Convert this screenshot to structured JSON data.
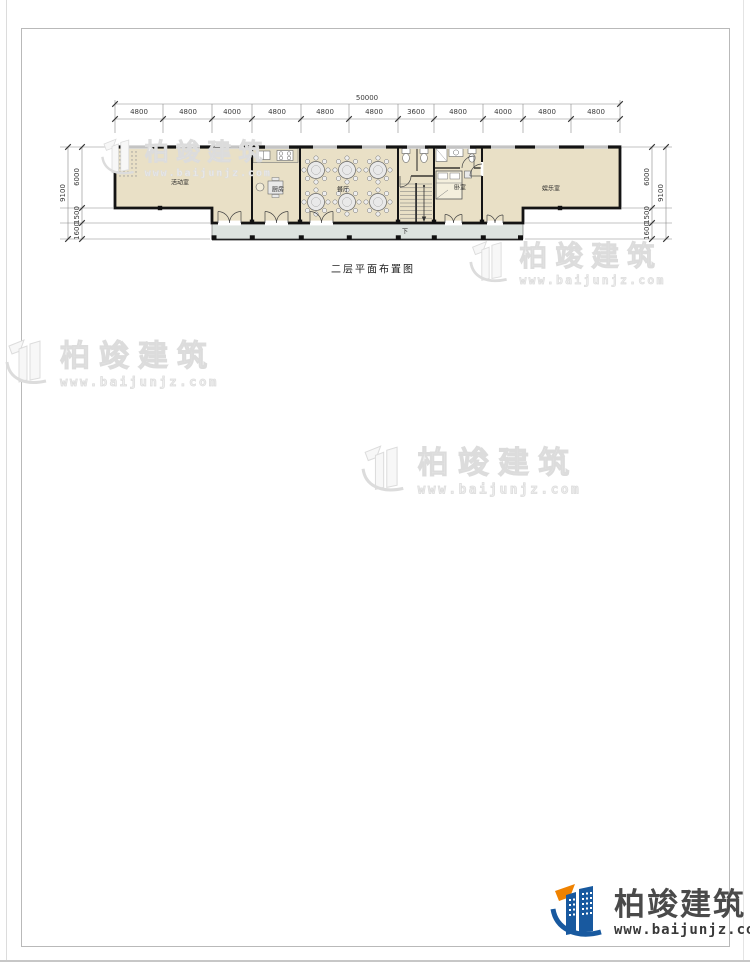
{
  "drawing_title": "二层平面布置图",
  "plan": {
    "room_labels": [
      "活动室",
      "厨房",
      "餐厅",
      "卧室",
      "娱乐室"
    ],
    "stair_down_label": "下"
  },
  "dimensions": {
    "top_total": "50000",
    "top_segments": [
      "4800",
      "4800",
      "4000",
      "4800",
      "4800",
      "4800",
      "3600",
      "4800",
      "4000",
      "4800",
      "4800"
    ],
    "left_total": "9100",
    "left_segments": [
      "6000",
      "1500",
      "1600"
    ],
    "right_total": "9100",
    "right_segments": [
      "6000",
      "1500",
      "1600"
    ]
  },
  "watermark": {
    "name": "柏竣建筑",
    "url": "www.baijunjz.com"
  },
  "logo": {
    "name": "柏竣建筑",
    "url": "www.baijunjz.com"
  },
  "colors": {
    "room_fill": "#e9e0c6",
    "balcony_fill": "#dde3df",
    "wall": "#141414",
    "logo_blue": "#18599f",
    "logo_orange": "#ef8200"
  }
}
